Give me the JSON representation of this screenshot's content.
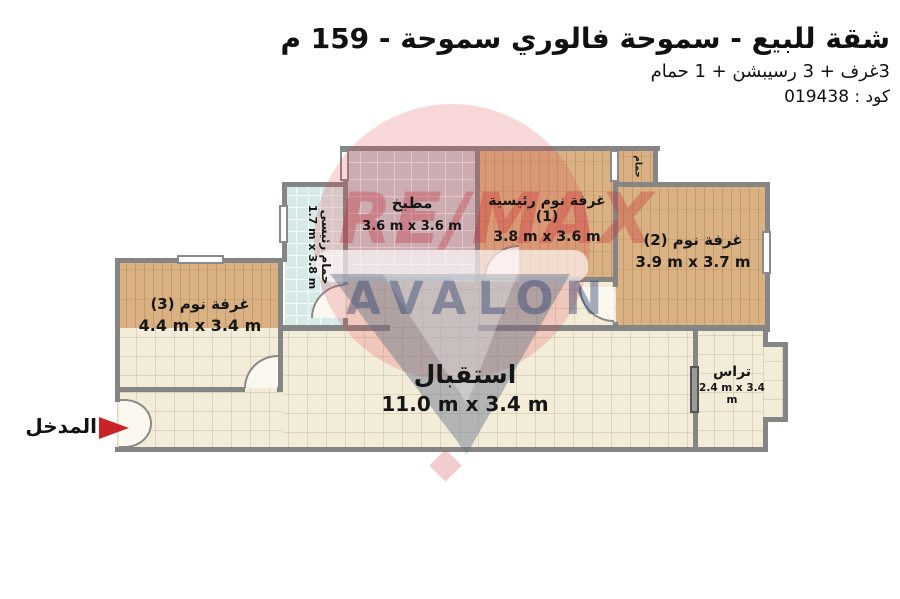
{
  "header": {
    "title": "شقة للبيع - سموحة فالوري سموحة - 159 م",
    "subtitle": "3غرف + 3 رسيبشن + 1 حمام",
    "code": "كود : 019438"
  },
  "entrance": {
    "label": "المدخل"
  },
  "watermark": {
    "brand": "RE/MAX",
    "name": "AVALON"
  },
  "rooms": [
    {
      "id": "kitchen",
      "name": "مطبخ",
      "dims": "3.6 m x 3.6 m"
    },
    {
      "id": "master-bedroom",
      "name": "غرفة نوم رئيسية (1)",
      "dims": "3.8 m x 3.6 m"
    },
    {
      "id": "bedroom-2",
      "name": "غرفة نوم (2)",
      "dims": "3.9 m x 3.7 m"
    },
    {
      "id": "bedroom-3",
      "name": "غرفة نوم (3)",
      "dims": "4.4 m x 3.4 m"
    },
    {
      "id": "main-bathroom",
      "name": "حمام رئيسى",
      "dims": "1.7 m x 3.8 m"
    },
    {
      "id": "small-bathroom",
      "name": "حمام",
      "dims": ""
    },
    {
      "id": "reception",
      "name": "استقبال",
      "dims": "11.0 m x 3.4 m"
    },
    {
      "id": "terrace",
      "name": "تراس",
      "dims": "2.4 m x 3.4 m"
    }
  ],
  "colors": {
    "arrow_red": "#c92227",
    "wall_gray": "#858585",
    "wood_floor": "#d9b183",
    "kitchen_tile": "#c6c9cc",
    "bath_tile": "#d6eae8",
    "cream_floor": "#f3ecd9",
    "watermark_red": "#c62834",
    "watermark_navy": "#203469"
  }
}
